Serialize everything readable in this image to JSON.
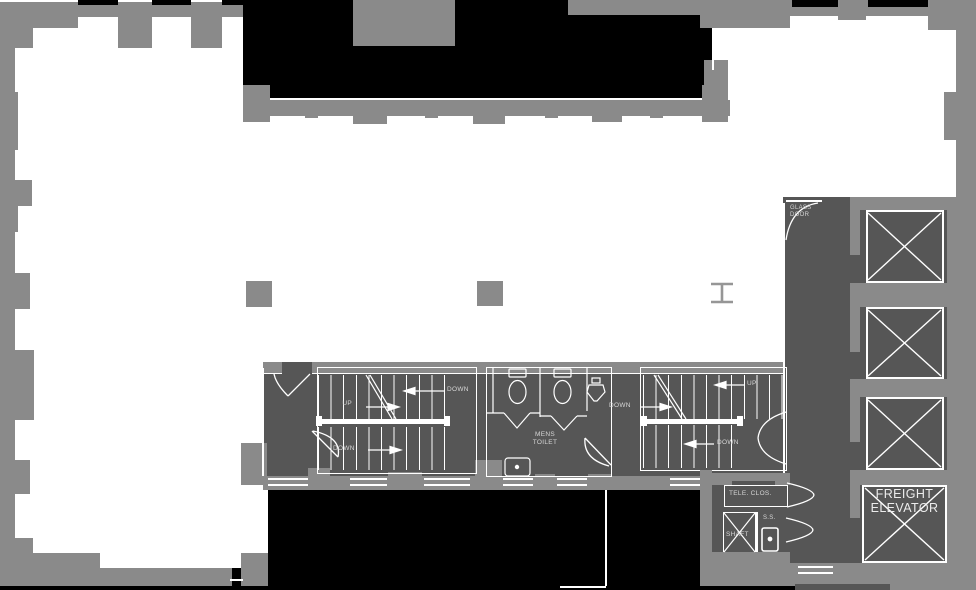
{
  "meta": {
    "drawing_type": "architectural floor plan"
  },
  "colors": {
    "outside": "#000000",
    "wall": "#8a8a8a",
    "core_fill": "#565656",
    "floor": "#ffffff",
    "line": "#ffffff",
    "label": "#d6d6d6"
  },
  "stair_west": {
    "up": "UP",
    "down_upper": "DOWN",
    "down_lower": "DOWN"
  },
  "stair_east": {
    "up": "UP",
    "down_upper": "DOWN",
    "down_lower": "DOWN"
  },
  "rooms": {
    "mens_toilet": {
      "line1": "MENS",
      "line2": "TOILET"
    },
    "glass_door": {
      "line1": "GLASS",
      "line2": "DOOR"
    },
    "tele_closet": "TELE. CLOS.",
    "shaft": "SHAFT",
    "slop_sink": "S.S.",
    "freight_elevator": {
      "line1": "FREIGHT",
      "line2": "ELEVATOR"
    }
  },
  "icons": {
    "elevator_car": "x-crossed-square",
    "shaft": "x-crossed-square",
    "toilet": "tank-and-bowl",
    "urinal": "wall-urinal",
    "sink": "rounded-basin",
    "slop_sink": "rounded-basin",
    "column": "square",
    "steel_column": "i-beam"
  }
}
